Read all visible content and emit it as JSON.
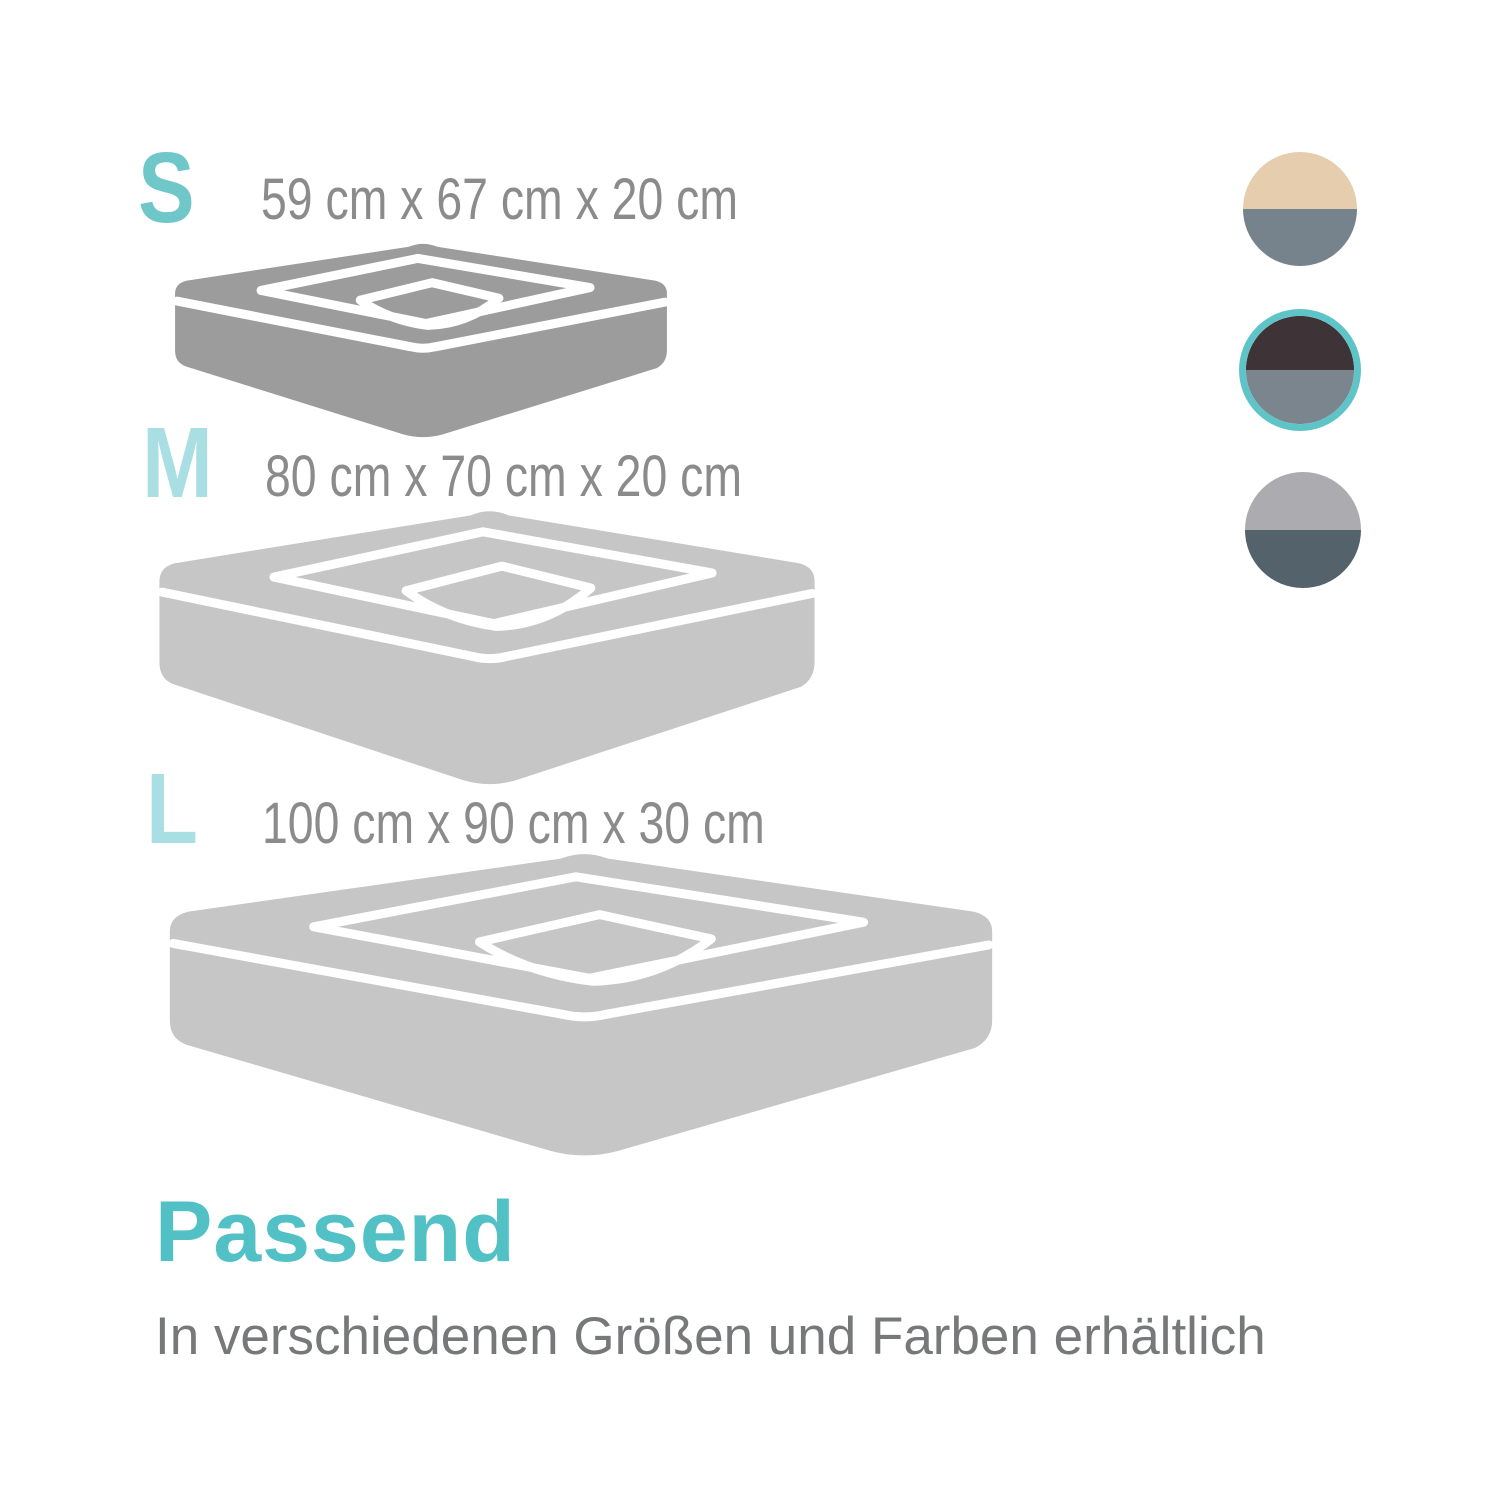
{
  "background": "#ffffff",
  "sizes": [
    {
      "label": "S",
      "dimensions": "59 cm x 67 cm x 20 cm",
      "label_color": "#6fc7ca",
      "bed_color": "#9c9c9c"
    },
    {
      "label": "M",
      "dimensions": "80 cm x 70 cm x 20 cm",
      "label_color": "#a9dfe2",
      "bed_color": "#c6c6c6"
    },
    {
      "label": "L",
      "dimensions": "100 cm x 90 cm x 30 cm",
      "label_color": "#a9dfe2",
      "bed_color": "#c6c6c6"
    }
  ],
  "colors": {
    "dimension_text": "#8b8b8b",
    "bed_line": "#ffffff",
    "selection_ring": "#5fc4c8"
  },
  "swatches": [
    {
      "name": "beige / gray",
      "top_color": "#e6cdad",
      "bottom_color": "#76838c",
      "selected": false
    },
    {
      "name": "dark brown / gray",
      "top_color": "#3e3336",
      "bottom_color": "#7b858d",
      "selected": true
    },
    {
      "name": "light gray / slate",
      "top_color": "#acacb0",
      "bottom_color": "#54626b",
      "selected": false
    }
  ],
  "footer": {
    "heading": "Passend",
    "heading_color": "#52c1c6",
    "subtitle": "In verschiedenen Größen und Farben erhältlich",
    "subtitle_color": "#77787a"
  }
}
